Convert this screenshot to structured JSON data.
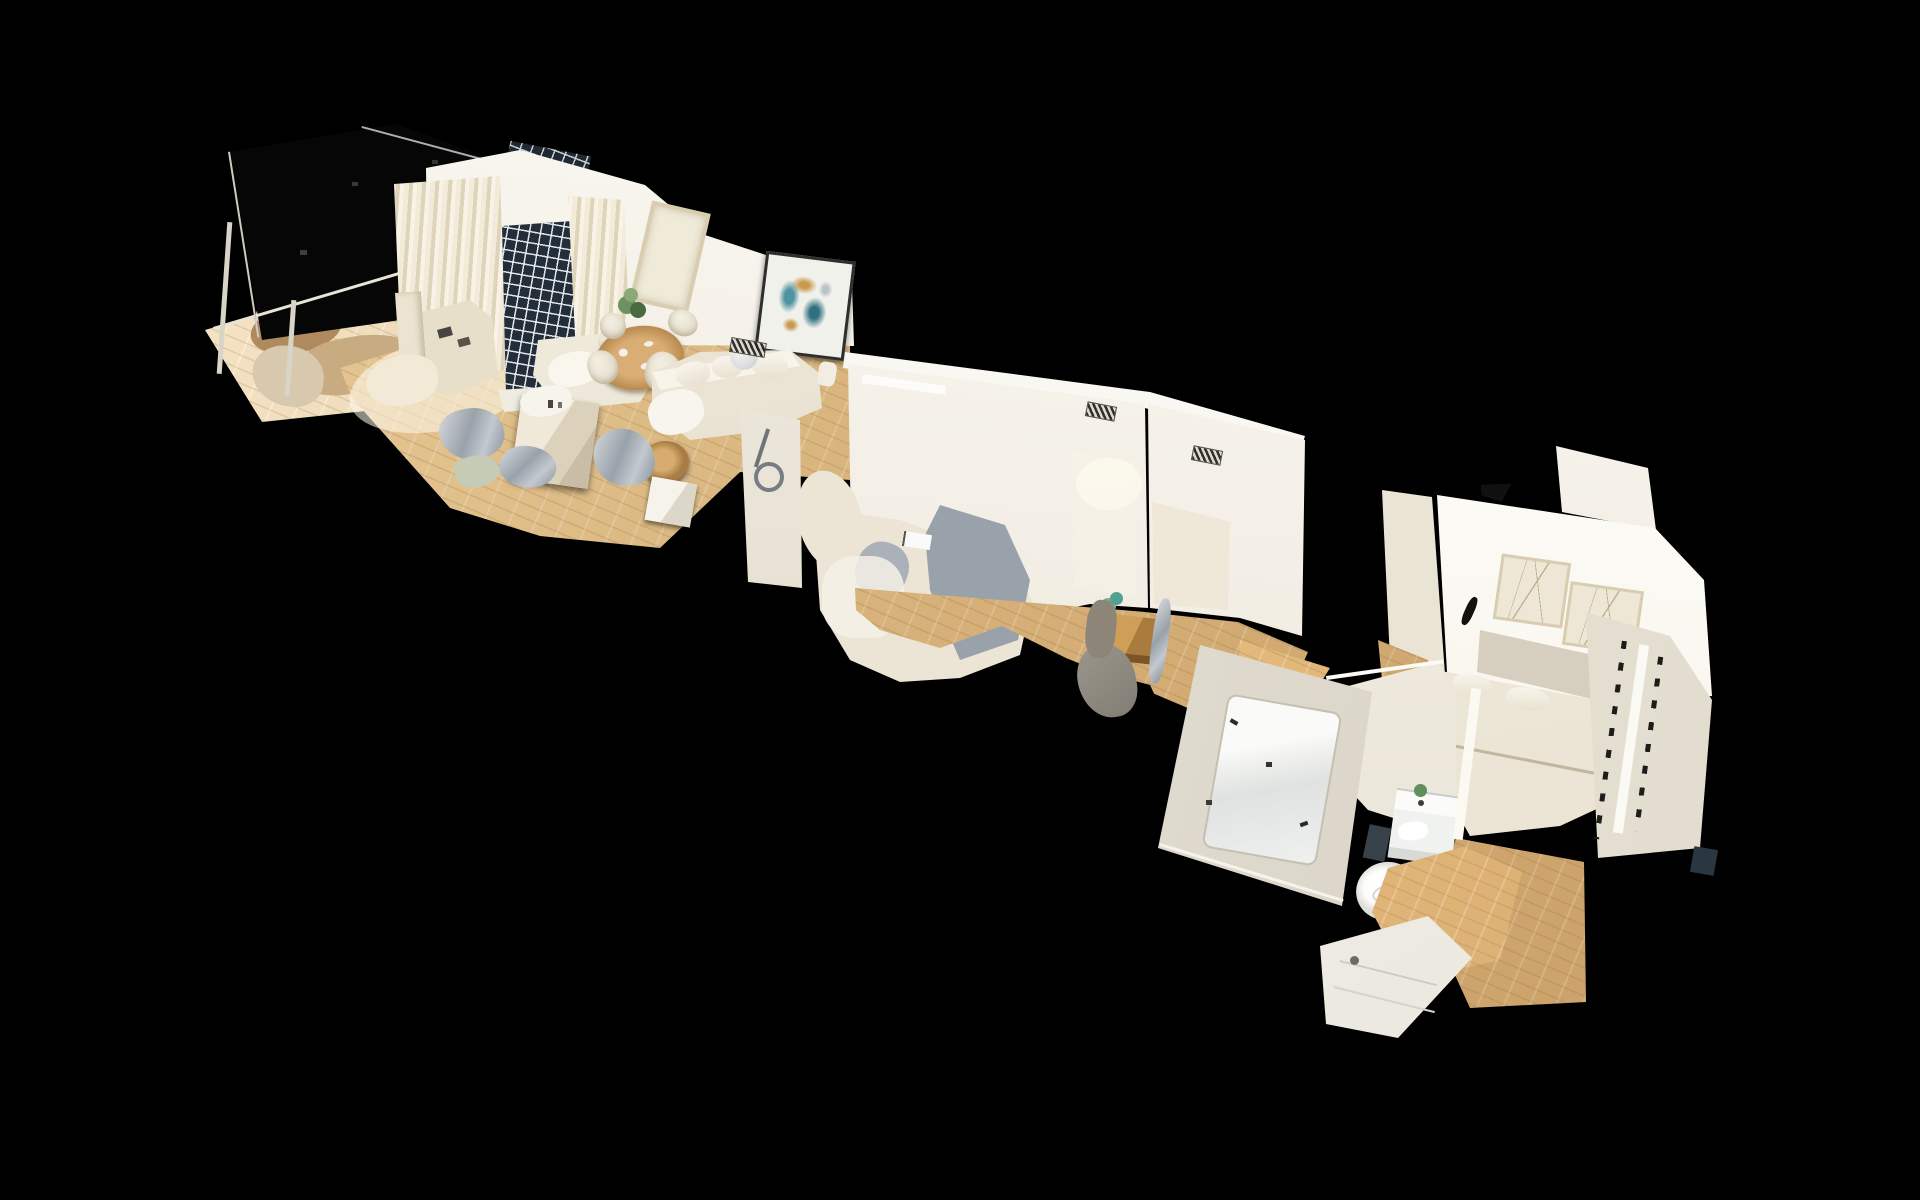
{
  "meta": {
    "title": "3D dollhouse cutaway view of a scanned apartment floating on a black background",
    "view_mode": "dollhouse",
    "background": "#000000"
  },
  "palette": {
    "bg": "#000000",
    "floor-hi": "#ecd2a0",
    "floor-mid": "#d6b078",
    "floor-lo": "#c69c63",
    "wall-bright": "#fcfaf5",
    "wall-light": "#f3efe6",
    "wall-mid": "#e2dbcb",
    "wall-shade": "#d2cab6",
    "curtain-light": "#f2ebd9",
    "curtain-mid": "#ded4ba",
    "window-dark": "#232e3a",
    "art-teal": "#4e93a0",
    "art-teal-dark": "#2f6f7e",
    "art-gold": "#c79a4e",
    "frame-dark": "#2e2e2c",
    "frame-beige": "#d9cdb0",
    "wood-furn": "#cf9f58",
    "wood-furn-dark": "#aa7b3e",
    "mesh-gray": "#99a1aa",
    "mesh-silver": "#c3c9cf",
    "plant-green": "#6f9061",
    "plant-dark": "#4a6a40",
    "fixture-white": "#fcfcfa",
    "vent-dark": "#1f1f1d",
    "navy": "#2a3640"
  },
  "scene": {
    "type": "point-cloud-dollhouse",
    "regions": [
      {
        "id": "terrace",
        "label": "terrace with railing and unscanned dark window wall"
      },
      {
        "id": "kitchen",
        "label": "kitchen with island and counters"
      },
      {
        "id": "living-dining",
        "label": "living-dining room with sofa, dining table, curtains, lattice door and abstract painting"
      },
      {
        "id": "bedroom-middle",
        "label": "middle bedroom with distorted scanned bed and two doorways"
      },
      {
        "id": "desk-nook",
        "label": "desk nook with wooden desk, plant and chair"
      },
      {
        "id": "hallway",
        "label": "hallway with mirror partition wall"
      },
      {
        "id": "bathroom",
        "label": "bathroom with vanity, toilet and shower tray"
      },
      {
        "id": "bedroom-right",
        "label": "main bedroom with headboard bed, two framed prints and wardrobe"
      }
    ]
  }
}
